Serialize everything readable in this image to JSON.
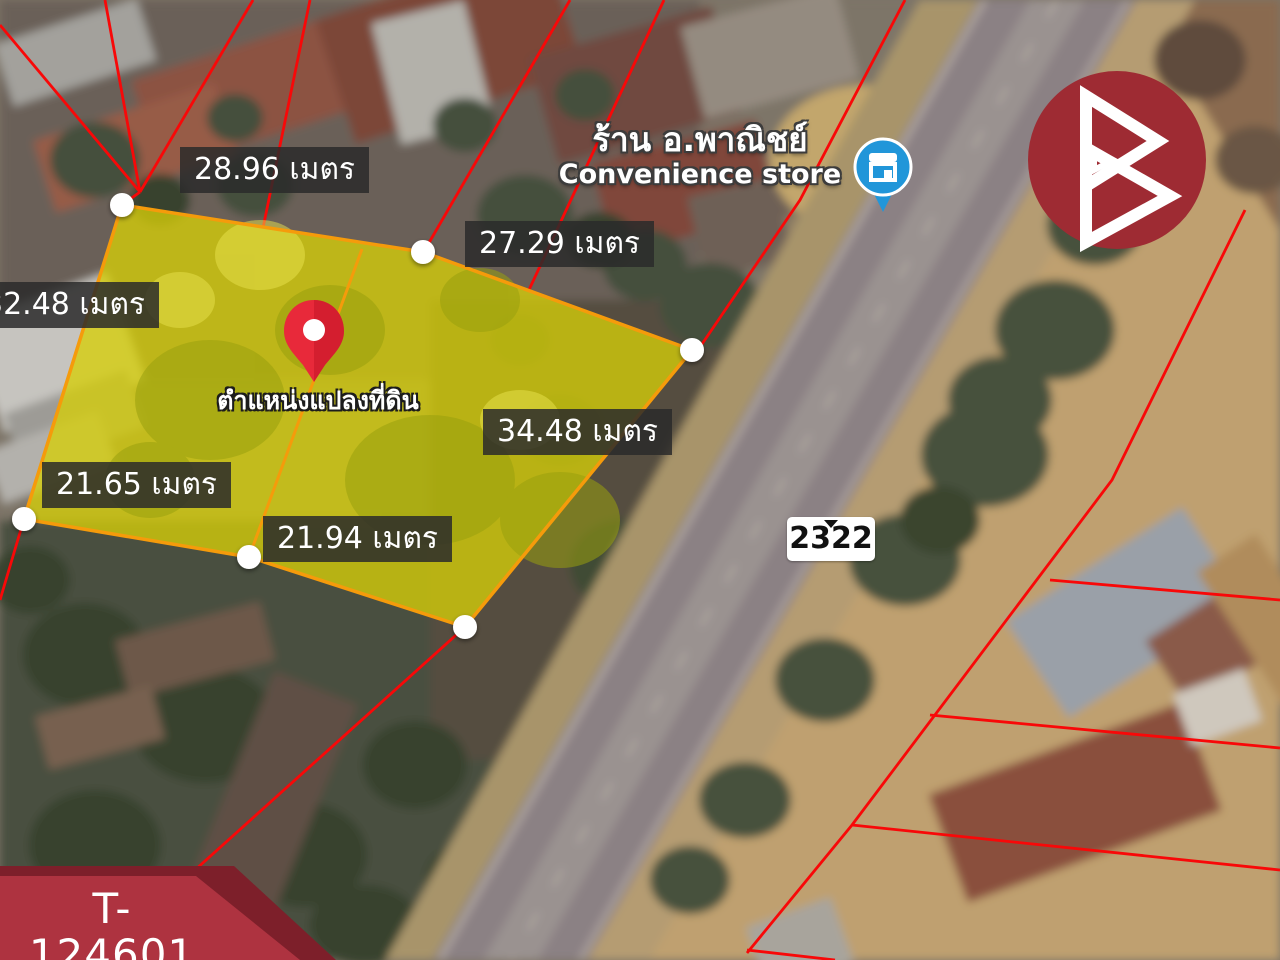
{
  "map": {
    "plot_marker_label": "ตำแหน่งแปลงที่ดิน",
    "road_number": "2322",
    "poi": {
      "name_th": "ร้าน อ.พาณิชย์",
      "name_en": "Convenience store"
    },
    "measurements": [
      {
        "edge": "top-left",
        "text": "28.96 เมตร"
      },
      {
        "edge": "top-right",
        "text": "27.29 เมตร"
      },
      {
        "edge": "left",
        "text": "32.48 เมตร"
      },
      {
        "edge": "right",
        "text": "34.48 เมตร"
      },
      {
        "edge": "bottom-left",
        "text": "21.65 เมตร"
      },
      {
        "edge": "bottom-middle",
        "text": "21.94 เมตร"
      }
    ]
  },
  "branding": {
    "listing_code": "T-124601",
    "listing_code_label": "รหัสทรัพย์"
  },
  "colors": {
    "parcel_line_red": "#f80808",
    "plot_fill_yellow": "#d6ce08",
    "plot_border_orange": "#f59b0b",
    "banner_red": "#ae3340",
    "banner_dark_red": "#7d1f2a",
    "logo_circle_red": "#9e2b33",
    "poi_marker_blue": "#2196d9",
    "location_pin_red": "#e8293a"
  }
}
